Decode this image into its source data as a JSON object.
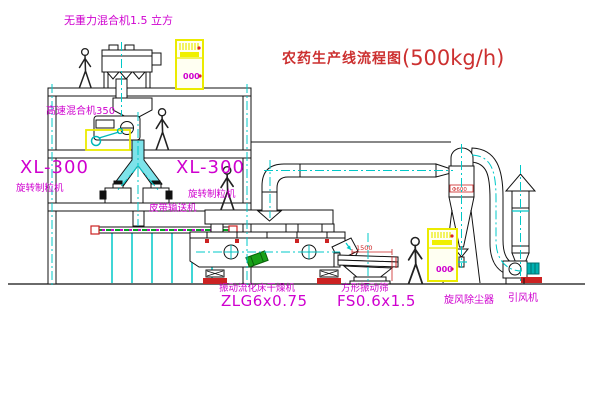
{
  "title": {
    "name": "农药生产线流程图",
    "capacity": "(500kg/h)"
  },
  "labels": {
    "gravity_mixer": "无重力混合机1.5 立方",
    "high_speed_mixer": "高速混合机350",
    "granulator_left": {
      "model": "XL-300",
      "name": "旋转制粒机"
    },
    "granulator_mid": {
      "model": "XL-300",
      "name": "旋转制粒机"
    },
    "belt_conveyor": "皮带输送机",
    "dryer": {
      "name": "振动流化床干燥机",
      "model": "ZLG6x0.75"
    },
    "sieve": {
      "name": "方形振动筛",
      "model": "FS0.6x1.5"
    },
    "cyclone": "旋风除尘器",
    "fan": "引风机"
  },
  "annotations": {
    "sieve_width_dim": "1500",
    "cyclone_mark": "Φ600",
    "cabinet_top_display": "000",
    "cabinet_right_display": "000"
  },
  "colors": {
    "label_magenta": "#cf00cf",
    "title_red": "#cc3030",
    "centerline_cyan": "#00c8c8",
    "cabinet_yellow": "#ebeb00",
    "alert_red": "#cc2222",
    "motor_green": "#18a018",
    "chute_cyan": "#7de3ea"
  }
}
